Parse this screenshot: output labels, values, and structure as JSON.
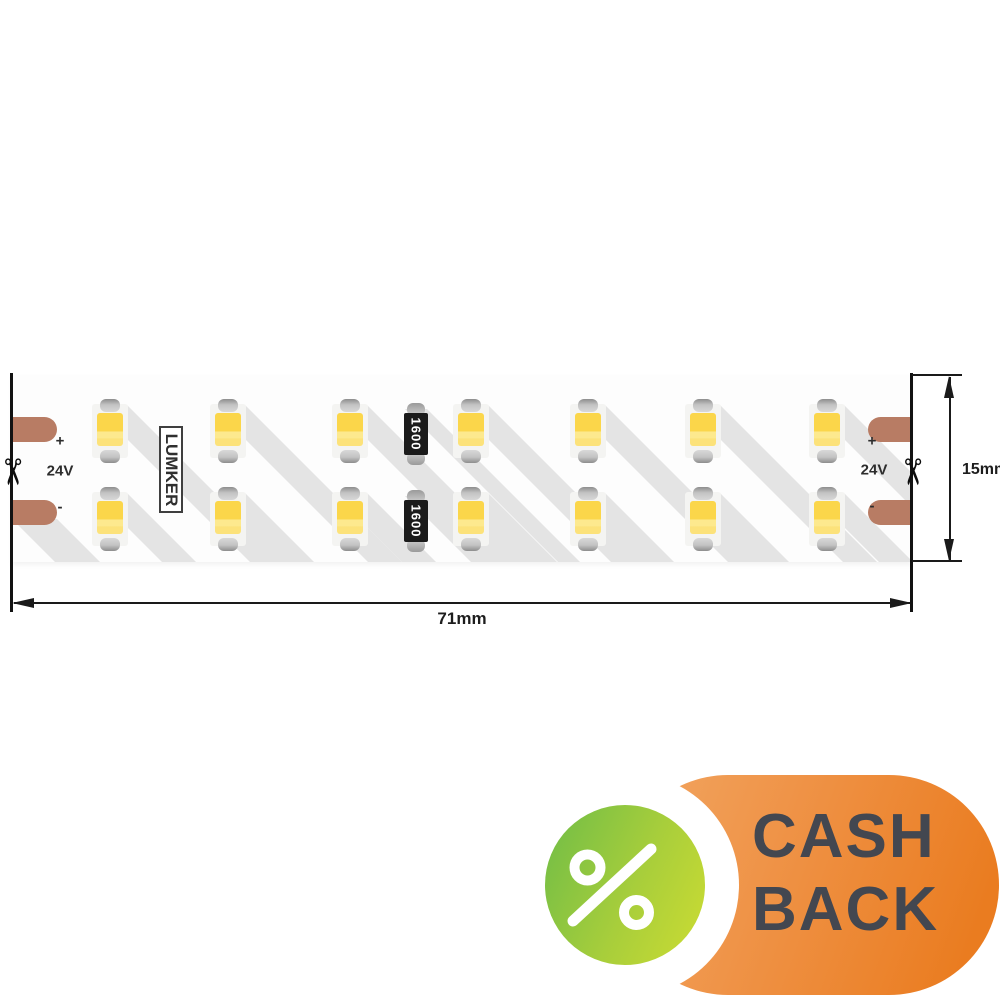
{
  "product": {
    "brand": "LUMKER",
    "voltage": "24V",
    "plus_label": "+",
    "minus_label": "-",
    "resistor_value": "1600",
    "led_rows": 2,
    "led_columns": 7,
    "resistor_count": 2
  },
  "dimensions": {
    "length_label": "71mm",
    "height_label": "15mm"
  },
  "badge": {
    "line1": "CASH",
    "line2": "BACK",
    "percent_symbol": "%"
  },
  "icons": {
    "scissors": "✂"
  },
  "colors": {
    "pad": "#b87c64",
    "shadow": "#e4e4e4",
    "led_yellow_main": "#fbd64a",
    "led_yellow_light": "#fde98e",
    "led_yellow_soft": "#fce27a",
    "badge_orange_start": "#f2a763",
    "badge_orange_end": "#ea7c20",
    "badge_green_start": "#77bf45",
    "badge_green_end": "#c9db33",
    "badge_text": "#434750"
  }
}
